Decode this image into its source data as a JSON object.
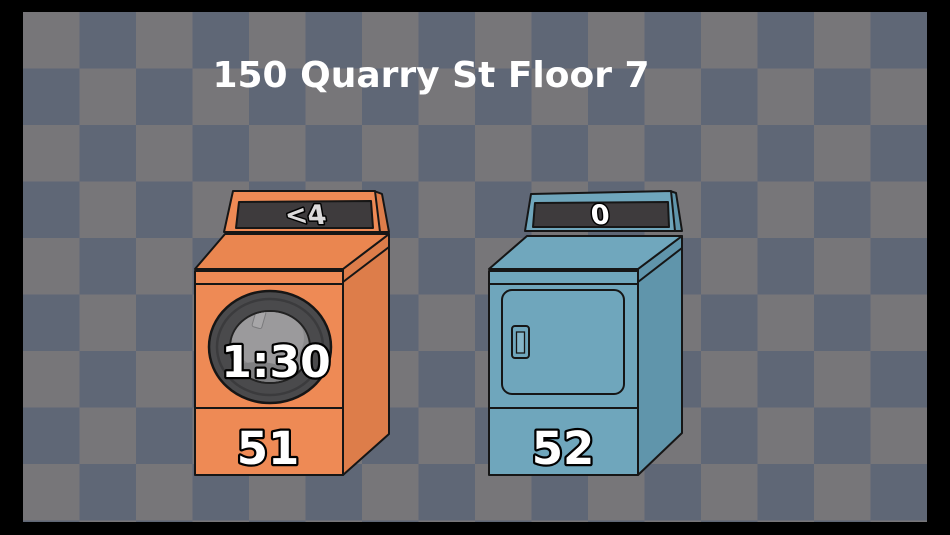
{
  "header": {
    "text": "150 Quarry St Floor 7",
    "color": "#FFFFFF"
  },
  "background": {
    "frame_color": "#000000",
    "checker_light": "#777679",
    "checker_dark": "#5F6776"
  },
  "display_panel_bg": "#3E3B3D",
  "machines": [
    {
      "number": "51",
      "type": "washer",
      "status_display": "<4",
      "time_remaining": "1:30",
      "body_color": "#EE8A55",
      "side_color": "#DD7D4A",
      "top_color": "#EA8650",
      "display_text_color": "#DBD9DA"
    },
    {
      "number": "52",
      "type": "dryer",
      "status_display": "0",
      "body_color": "#6FA6BC",
      "side_color": "#6095AB",
      "top_color": "#70A7BD",
      "display_text_color": "#FFFFFF"
    }
  ]
}
